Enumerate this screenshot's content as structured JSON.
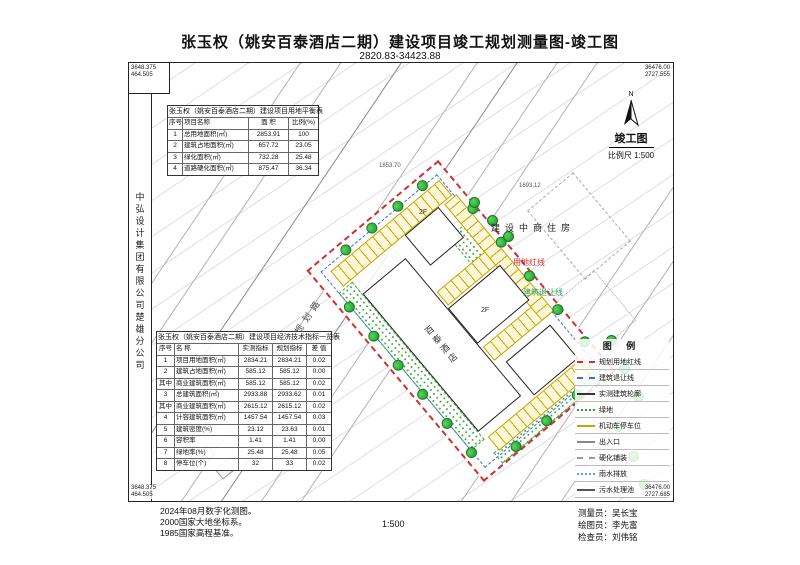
{
  "title": "张玉权（姚安百泰酒店二期）建设项目竣工规划测量图-竣工图",
  "subtitle": "2820.83-34423.88",
  "company": "中弘设计集团有限公司楚雄分公司",
  "corner_coords": {
    "tl": [
      "3648.375",
      "464.505"
    ],
    "tr": [
      "36476.00",
      "2727.555"
    ],
    "bl": [
      "3648.375",
      "464.505"
    ],
    "br": [
      "36476.00",
      "2727.685"
    ]
  },
  "north": {
    "n": "N",
    "drawing_label": "竣工图",
    "scale_label": "比例尺 1:500"
  },
  "land_balance_table": {
    "title": "张玉权（姚安百泰酒店二期）建设项目用地平衡表",
    "headers": [
      "序号",
      "项目名称",
      "面 积",
      "比例(%)"
    ],
    "rows": [
      {
        "no": "1",
        "name": "总用地面积(㎡)",
        "v1": "2853.91",
        "v2": "100"
      },
      {
        "no": "2",
        "name": "建筑占地面积(㎡)",
        "v1": "657.72",
        "v2": "23.05"
      },
      {
        "no": "3",
        "name": "绿化面积(㎡)",
        "v1": "732.28",
        "v2": "25.48"
      },
      {
        "no": "4",
        "name": "道路硬化面积(㎡)",
        "v1": "875.47",
        "v2": "36.34"
      }
    ]
  },
  "indicator_table": {
    "title": "张玉权（姚安百泰酒店二期）建设项目经济技术指标一览表",
    "headers": [
      "序号",
      "名 称",
      "实测指标",
      "规划指标",
      "差 值"
    ],
    "rows": [
      {
        "no": "1",
        "name": "项目用地面积(㎡)",
        "m": "2834.21",
        "p": "2834.21",
        "d": "0.02"
      },
      {
        "no": "2",
        "name": "建筑占地面积(㎡)",
        "m": "585.12",
        "p": "585.12",
        "d": "0.00"
      },
      {
        "no": "其中",
        "name": "商业建筑面积(㎡)",
        "m": "585.12",
        "p": "585.12",
        "d": "0.02"
      },
      {
        "no": "3",
        "name": "总建筑面积(㎡)",
        "m": "2933.88",
        "p": "2933.62",
        "d": "0.01"
      },
      {
        "no": "其中",
        "name": "商业建筑面积(㎡)",
        "m": "2615.12",
        "p": "2615.12",
        "d": "0.02"
      },
      {
        "no": "4",
        "name": "计容建筑面积(㎡)",
        "m": "1457.54",
        "p": "1457.54",
        "d": "0.03"
      },
      {
        "no": "5",
        "name": "建筑密度(%)",
        "m": "23.12",
        "p": "23.63",
        "d": "0.01"
      },
      {
        "no": "6",
        "name": "容积率",
        "m": "1.41",
        "p": "1.41",
        "d": "0.00"
      },
      {
        "no": "7",
        "name": "绿地率(%)",
        "m": "25.48",
        "p": "25.48",
        "d": "0.05"
      },
      {
        "no": "8",
        "name": "停车位(个)",
        "m": "32",
        "p": "33",
        "d": "0.02"
      }
    ]
  },
  "legend": {
    "title": "图 例",
    "items": [
      {
        "label": "规划用地红线",
        "sym": "2px dashed #d03030"
      },
      {
        "label": "建筑退让线",
        "sym": "2px dashed #3a6fd8"
      },
      {
        "label": "实测建筑轮廓",
        "sym": "2px solid #333333"
      },
      {
        "label": "绿地",
        "sym": "2px dotted #2f9e2f"
      },
      {
        "label": "机动车停车位",
        "sym": "2px solid #c8a400"
      },
      {
        "label": "出入口",
        "sym": "2px solid #888888"
      },
      {
        "label": "硬化铺装",
        "sym": "2px dashed #999999"
      },
      {
        "label": "雨水排放",
        "sym": "2px dotted #55aacc"
      },
      {
        "label": "污水处理池",
        "sym": "2px solid #555555"
      }
    ]
  },
  "site": {
    "hotel_label": "百泰酒店",
    "floors": [
      "2F",
      "2F"
    ],
    "redline_label": "用地红线",
    "setback_label": "建筑退让线",
    "neighbor_label": "建设中商住房",
    "road_label": "规划路",
    "dims": [
      "1853.70",
      "1693.12"
    ]
  },
  "footer": {
    "notes": [
      "2024年08月数字化测图。",
      "2000国家大地坐标系。",
      "1985国家高程基准。"
    ],
    "scale": "1:500",
    "crew": [
      "测量员：吴长宝",
      "绘图员：李先富",
      "检查员：刘伟铭"
    ]
  },
  "colors": {
    "redline": "#d03030",
    "setback": "#3a6fd8",
    "green": "#2f9e2f",
    "parking": "#c8a400"
  }
}
